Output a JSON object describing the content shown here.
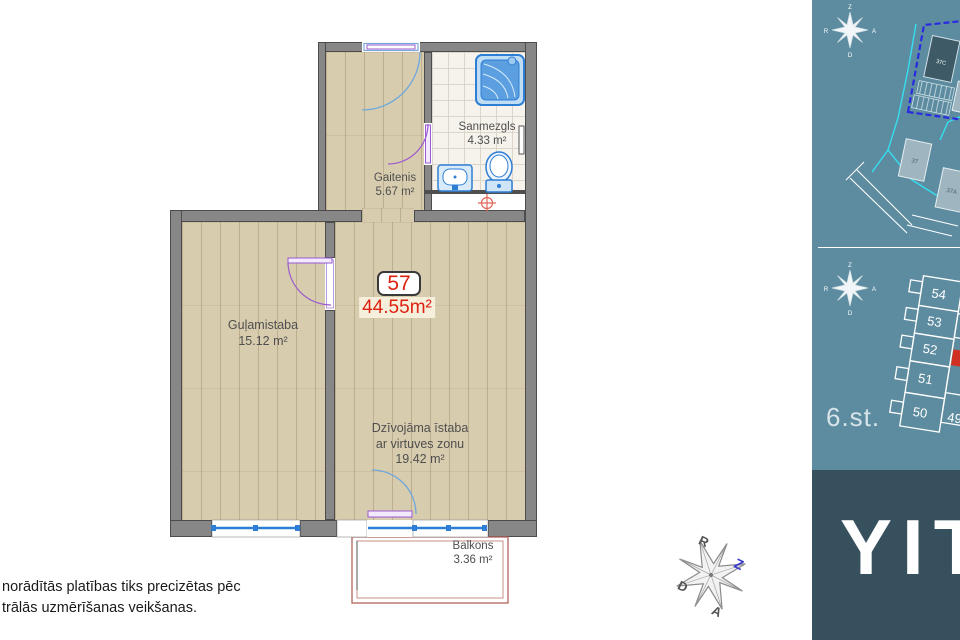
{
  "plan": {
    "apartment_number": "57",
    "total_area": "44.55m²",
    "rooms": {
      "sanmezgls": {
        "name": "Sanmezgls",
        "area": "4.33 m²"
      },
      "gaitenis": {
        "name": "Gaitenis",
        "area": "5.67 m²"
      },
      "gulamistaba": {
        "name": "Guļamistaba",
        "area": "15.12 m²"
      },
      "dzivojama": {
        "line1": "Dzīvojāma īstaba",
        "line2": "ar virtuves zonu",
        "area": "19.42 m²"
      },
      "balkons": {
        "name": "Balkons",
        "area": "3.36 m²"
      }
    }
  },
  "disclaimer": {
    "line1": "norādītās platības tiks precizētas pēc",
    "line2": "trālās uzmērīšanas veikšanas."
  },
  "compass": {
    "north": "Z",
    "south": "D",
    "east": "A",
    "west": "R"
  },
  "sidebar": {
    "site_plan": {
      "current_building": "37C",
      "building_a": "37",
      "building_b": "37A"
    },
    "floor_label": "6.st.",
    "units": [
      "54",
      "53",
      "52",
      "51",
      "50"
    ],
    "partial_unit": "49",
    "brand": "YIT"
  },
  "colors": {
    "accent_red": "#dd2211",
    "window_blue": "#2e7ed6",
    "door_purple": "#9a5bd0",
    "sidebar_teal": "#5d8ca0",
    "brand_panel": "#36515d",
    "cyan": "#35dff0",
    "plot_dashed_blue": "#2a2ae0"
  }
}
